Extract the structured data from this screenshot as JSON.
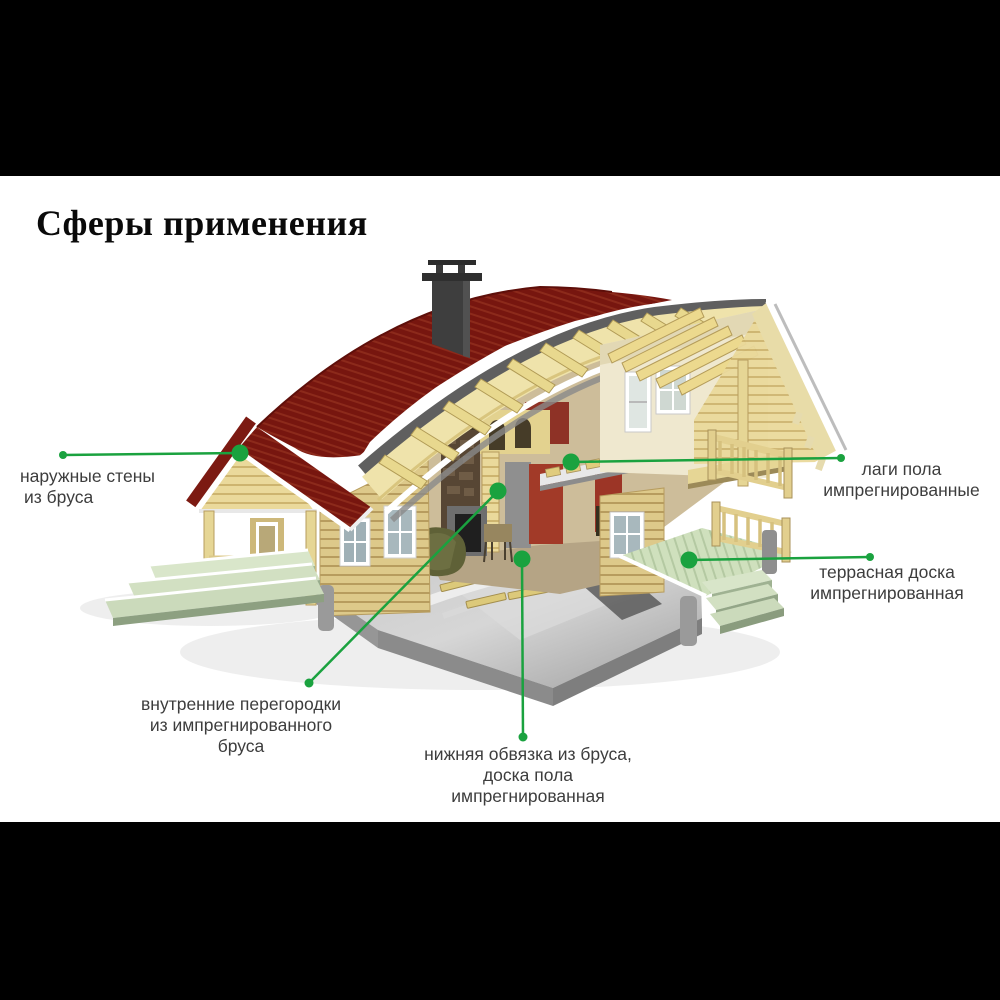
{
  "title": "Сферы применения",
  "colors": {
    "accent_green": "#1aa23f",
    "roof_red": "#7a1a12",
    "wall_wood": "#e9d89a",
    "foundation_gray": "#b5b5b5",
    "deck_green": "#cfe0bd",
    "background": "#000000",
    "canvas": "#ffffff"
  },
  "callouts": [
    {
      "id": "outer-walls",
      "lines": [
        "наружные стены",
        "из бруса"
      ]
    },
    {
      "id": "floor-joists",
      "lines": [
        "лаги пола",
        "импрегнированные"
      ]
    },
    {
      "id": "terrace-board",
      "lines": [
        "террасная доска",
        "импрегнированная"
      ]
    },
    {
      "id": "inner-partitions",
      "lines": [
        "внутренние перегородки",
        "из импрегнированного",
        "бруса"
      ]
    },
    {
      "id": "bottom-frame",
      "lines": [
        "нижняя обвязка из бруса,",
        "доска пола",
        "импрегнированная"
      ]
    }
  ]
}
